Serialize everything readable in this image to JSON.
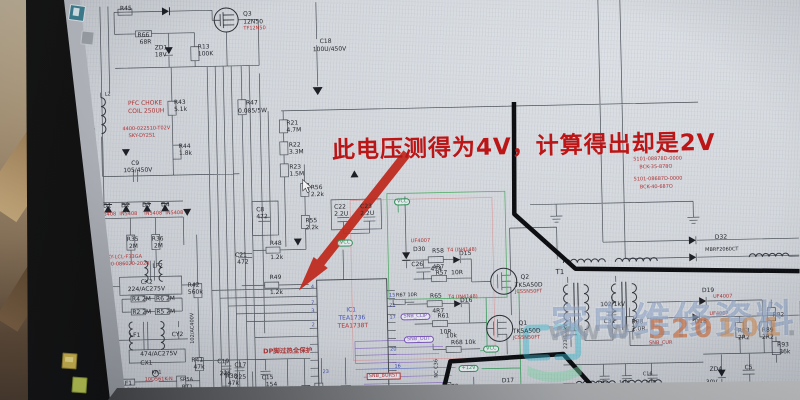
{
  "annotation": {
    "text": "此电压测得为4V，计算得出却是2V",
    "color": "#bf1414"
  },
  "watermark": {
    "site": "家电维修资料网",
    "url": {
      "prefix": "www.",
      "a": "520",
      "b": "101",
      "suffix": ".com"
    }
  },
  "schematic": {
    "labels": [
      [
        "R45",
        124,
        0,
        "k"
      ],
      [
        "Q3",
        247,
        8,
        "k"
      ],
      [
        "12N50",
        247,
        16,
        "k"
      ],
      [
        "TF12N50",
        247,
        23,
        "r s5"
      ],
      [
        "R66",
        141,
        27,
        "k"
      ],
      [
        "68R",
        143,
        34,
        "k"
      ],
      [
        "ZD1",
        158,
        40,
        "k"
      ],
      [
        "18V",
        158,
        47,
        "k"
      ],
      [
        "R13",
        201,
        40,
        "k"
      ],
      [
        "100K",
        201,
        47,
        "k"
      ],
      [
        "C18",
        323,
        37,
        "k"
      ],
      [
        "100U/450V",
        316,
        45,
        "k"
      ],
      [
        "L2",
        107,
        86,
        "k s5"
      ],
      [
        "PFC CHOKE",
        130,
        95,
        "r"
      ],
      [
        "COIL 250UH",
        130,
        103,
        "r"
      ],
      [
        "4400-022510-T02V",
        124,
        121,
        "r s5"
      ],
      [
        "SKY-DY2S1",
        130,
        128,
        "r s5"
      ],
      [
        "R43",
        176,
        95,
        "k"
      ],
      [
        "5.1k",
        176,
        102,
        "k"
      ],
      [
        "R44",
        180,
        139,
        "k"
      ],
      [
        "1.8k",
        180,
        146,
        "k"
      ],
      [
        "C9",
        132,
        155,
        "k"
      ],
      [
        "105/450V",
        124,
        162,
        "k"
      ],
      [
        "R47",
        248,
        97,
        "k"
      ],
      [
        "0.085/5W",
        240,
        105,
        "k"
      ],
      [
        "R21",
        288,
        118,
        "k"
      ],
      [
        "4.7M",
        288,
        125,
        "k"
      ],
      [
        "R22",
        290,
        140,
        "k"
      ],
      [
        "3.3M",
        290,
        147,
        "k"
      ],
      [
        "R23",
        290,
        162,
        "k"
      ],
      [
        "1.5M",
        290,
        169,
        "k"
      ],
      [
        "D1",
        103,
        197,
        "k"
      ],
      [
        "D2",
        121,
        197,
        "k"
      ],
      [
        "D3",
        142,
        197,
        "k"
      ],
      [
        "D4",
        161,
        197,
        "k"
      ],
      [
        "IN5408  IN5408",
        98,
        206,
        "r s5"
      ],
      [
        "IN5408  IN5408",
        144,
        206,
        "r s5"
      ],
      [
        "R35",
        126,
        231,
        "k"
      ],
      [
        "2M",
        128,
        238,
        "k"
      ],
      [
        "R36",
        151,
        231,
        "k"
      ],
      [
        "2M",
        153,
        238,
        "k"
      ],
      [
        "SKY-LCL-F33GA",
        103,
        249,
        "r s5"
      ],
      [
        "4400-086020-2020",
        100,
        256,
        "r s5"
      ],
      [
        "LF2",
        151,
        258,
        "k"
      ],
      [
        "CX2",
        139,
        274,
        "k"
      ],
      [
        "224/AC275V",
        126,
        281,
        "k"
      ],
      [
        "R4 2M",
        130,
        291,
        "k"
      ],
      [
        "R6 2M",
        154,
        291,
        "k"
      ],
      [
        "R2 2M",
        130,
        304,
        "k"
      ],
      [
        "R5 2M",
        154,
        304,
        "k"
      ],
      [
        "CY1",
        104,
        327,
        "k"
      ],
      [
        "LF1",
        127,
        327,
        "k"
      ],
      [
        "CY2",
        169,
        327,
        "k"
      ],
      [
        "102/AC400V",
        98,
        341,
        "k s5 vert"
      ],
      [
        "102/AC400V",
        188,
        339,
        "k s5 vert"
      ],
      [
        "474/AC275V",
        137,
        346,
        "k"
      ],
      [
        "CX1",
        137,
        355,
        "k"
      ],
      [
        "KR1",
        148,
        365,
        "k s5"
      ],
      [
        "10D561K-N",
        141,
        372,
        "r s5"
      ],
      [
        "F1",
        121,
        375,
        "k"
      ],
      [
        "T5AL250V",
        108,
        382,
        "k"
      ],
      [
        "SR5A",
        176,
        373,
        "k s5"
      ],
      [
        "RT1",
        178,
        380,
        "k"
      ],
      [
        "UFT2",
        178,
        388,
        "r s5"
      ],
      [
        "R42",
        186,
        278,
        "k"
      ],
      [
        "560k",
        186,
        285,
        "k"
      ],
      [
        "R41",
        188,
        353,
        "k"
      ],
      [
        "47k",
        190,
        360,
        "k"
      ],
      [
        "C21",
        234,
        249,
        "k"
      ],
      [
        "472",
        236,
        256,
        "k"
      ],
      [
        "R48",
        269,
        238,
        "k"
      ],
      [
        "1.2k",
        269,
        252,
        "k"
      ],
      [
        "R49",
        268,
        272,
        "k"
      ],
      [
        "1.2k",
        268,
        287,
        "k"
      ],
      [
        "C8",
        256,
        204,
        "k"
      ],
      [
        "472",
        256,
        211,
        "k"
      ],
      [
        "R56",
        311,
        183,
        "k"
      ],
      [
        "2.2k",
        311,
        190,
        "k"
      ],
      [
        "R55",
        305,
        216,
        "k"
      ],
      [
        "2.2k",
        305,
        223,
        "k"
      ],
      [
        "C22",
        334,
        203,
        "k"
      ],
      [
        "2.2U",
        334,
        210,
        "k"
      ],
      [
        "C23",
        360,
        203,
        "k"
      ],
      [
        "2.2U",
        360,
        210,
        "k"
      ],
      [
        "VCC",
        394,
        198,
        "g pill s5"
      ],
      [
        "VCC",
        336,
        238,
        "g pill s5"
      ],
      [
        "UF4007",
        410,
        239,
        "r s5"
      ],
      [
        "D30",
        412,
        247,
        "k"
      ],
      [
        "IC1",
        344,
        306,
        "b"
      ],
      [
        "TEA1736",
        336,
        314,
        "b"
      ],
      [
        "TEA1738T",
        335,
        322,
        "r"
      ],
      [
        "C26",
        410,
        262,
        "k"
      ],
      [
        "474",
        429,
        267,
        "k"
      ],
      [
        "R58",
        431,
        249,
        "k"
      ],
      [
        "4R7",
        431,
        265,
        "k"
      ],
      [
        "T4 (IN4148)",
        446,
        249,
        "r s5"
      ],
      [
        "D15",
        458,
        252,
        "k"
      ],
      [
        "R57  10R",
        434,
        271,
        "k"
      ],
      [
        "Q2",
        519,
        277,
        "k"
      ],
      [
        "TK5A50D",
        513,
        285,
        "k"
      ],
      [
        "JCS5N50FT",
        513,
        292,
        "r s5"
      ],
      [
        "T4 (IN4148)",
        446,
        296,
        "r s5"
      ],
      [
        "R65",
        428,
        294,
        "k"
      ],
      [
        "4R7",
        430,
        309,
        "k"
      ],
      [
        "D16",
        458,
        299,
        "k"
      ],
      [
        "R61",
        435,
        314,
        "k"
      ],
      [
        "10R",
        437,
        330,
        "k"
      ],
      [
        "Q1",
        516,
        323,
        "k"
      ],
      [
        "TK5A50D",
        510,
        331,
        "k"
      ],
      [
        "JCS5N50FT",
        510,
        338,
        "r s5"
      ],
      [
        "SNB_CLIP",
        398,
        313,
        "v pill s5"
      ],
      [
        "SNB_OUT",
        401,
        336,
        "v pill s5"
      ],
      [
        "10k",
        443,
        334,
        "k"
      ],
      [
        "R68 10k",
        448,
        341,
        "k"
      ],
      [
        "VCC",
        480,
        347,
        "g pill s5"
      ],
      [
        "+12V",
        455,
        366,
        "g pill s5"
      ],
      [
        "NC C36",
        431,
        378,
        "k s5 vert"
      ],
      [
        "R72",
        443,
        385,
        "k"
      ],
      [
        "D17",
        498,
        380,
        "k"
      ],
      [
        "T4 (IN4148)",
        509,
        387,
        "r s5"
      ],
      [
        "OVP",
        557,
        386,
        "r pill s5"
      ],
      [
        "SNB_BURST",
        363,
        372,
        "r box s5"
      ],
      [
        "DP脚过热全保护",
        260,
        345,
        "r s6"
      ],
      [
        "R38",
        222,
        370,
        "k"
      ],
      [
        "47k",
        224,
        377,
        "k"
      ],
      [
        "C19",
        214,
        355,
        "k"
      ],
      [
        "225",
        216,
        367,
        "k"
      ],
      [
        "C17",
        231,
        359,
        "k"
      ],
      [
        "225",
        231,
        371,
        "k"
      ],
      [
        "C15",
        258,
        372,
        "k"
      ],
      [
        "154",
        262,
        379,
        "k"
      ],
      [
        "C14",
        245,
        386,
        "k"
      ],
      [
        "474",
        247,
        393,
        "k"
      ],
      [
        "C11",
        280,
        386,
        "k"
      ],
      [
        "225",
        282,
        393,
        "k"
      ],
      [
        "R37",
        299,
        384,
        "k"
      ],
      [
        "75k",
        301,
        391,
        "k"
      ],
      [
        "684",
        316,
        395,
        "k s5 vert"
      ],
      [
        "C13",
        338,
        386,
        "k"
      ],
      [
        "331",
        340,
        392,
        "k"
      ],
      [
        "4",
        309,
        283,
        "b s5"
      ],
      [
        "7",
        309,
        299,
        "b s5"
      ],
      [
        "3",
        309,
        307,
        "b s5"
      ],
      [
        "2",
        309,
        321,
        "b s5"
      ],
      [
        "23",
        319,
        368,
        "b s5"
      ],
      [
        "15",
        387,
        293,
        "b s5"
      ],
      [
        "21",
        387,
        303,
        "b s5"
      ],
      [
        "17",
        387,
        315,
        "b s5"
      ],
      [
        "20",
        387,
        347,
        "b s5"
      ],
      [
        "16",
        391,
        364,
        "b s5"
      ],
      [
        "R67 10R",
        394,
        293,
        "k s5"
      ],
      [
        "T1",
        554,
        272,
        "k s7"
      ],
      [
        "223/1.6kV",
        561,
        352,
        "k s5 vert"
      ],
      [
        "102/1kV",
        598,
        306,
        "k"
      ],
      [
        "C31",
        601,
        323,
        "k"
      ],
      [
        "R88",
        629,
        324,
        "k"
      ],
      [
        "2.0R",
        629,
        331,
        "k"
      ],
      [
        "SNB_CUR",
        646,
        346,
        "r s5"
      ],
      [
        "D19",
        700,
        294,
        "k"
      ],
      [
        "UF4007",
        711,
        301,
        "r s5"
      ],
      [
        "UF4007",
        707,
        318,
        "r s5"
      ],
      [
        "D18",
        692,
        325,
        "k"
      ],
      [
        "R83",
        735,
        335,
        "k"
      ],
      [
        "2R2",
        735,
        342,
        "k"
      ],
      [
        "R89",
        759,
        335,
        "k"
      ],
      [
        "2R2",
        759,
        342,
        "k"
      ],
      [
        "R92",
        770,
        320,
        "k"
      ],
      [
        "R93",
        774,
        350,
        "k"
      ],
      [
        "36k",
        776,
        357,
        "k"
      ],
      [
        "ZD4",
        706,
        373,
        "k"
      ],
      [
        "30V",
        702,
        386,
        "k"
      ],
      [
        "C5",
        741,
        372,
        "k"
      ],
      [
        "100U/50V",
        735,
        389,
        "k"
      ],
      [
        "103",
        593,
        385,
        "k"
      ],
      [
        "104",
        615,
        385,
        "k"
      ],
      [
        "C16",
        639,
        377,
        "k s5"
      ],
      [
        "104",
        641,
        385,
        "k"
      ],
      [
        "D32",
        714,
        241,
        "k"
      ],
      [
        "MBRF2060CT",
        704,
        254,
        "k s5"
      ],
      [
        "5101-08878D-0000",
        634,
        162,
        "r s5"
      ],
      [
        "BCK-35-878O",
        640,
        170,
        "r s5"
      ],
      [
        "5101-08687D-0000",
        634,
        182,
        "r s5"
      ],
      [
        "BCK-40-687O",
        640,
        190,
        "r s5"
      ]
    ]
  }
}
